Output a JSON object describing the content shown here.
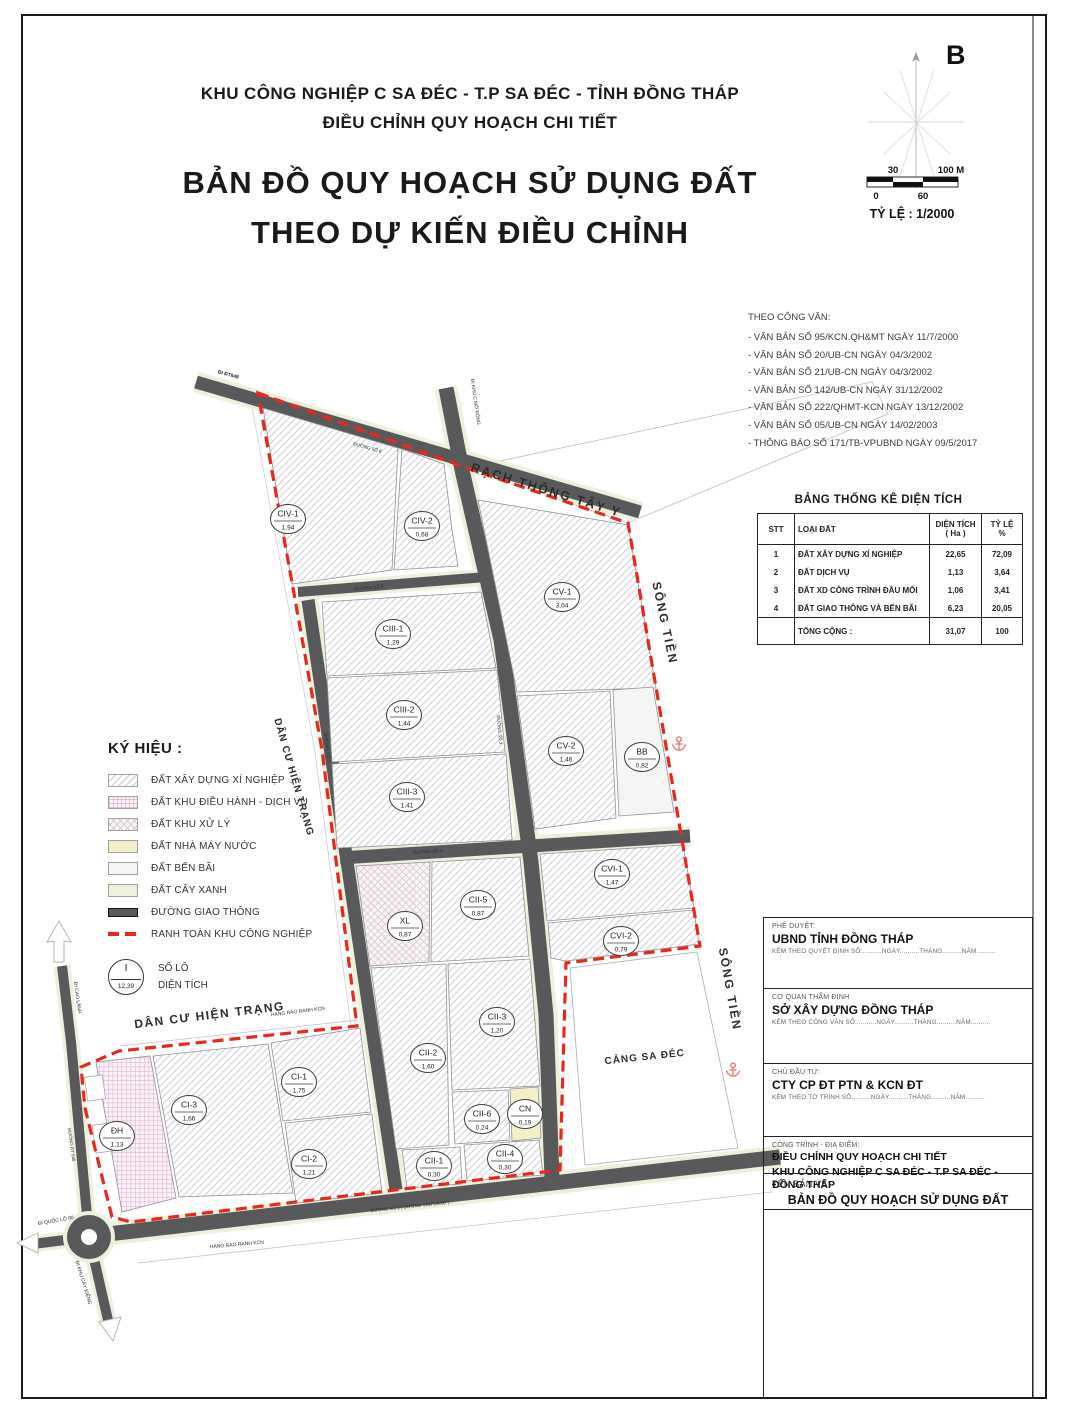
{
  "header": {
    "line1": "KHU CÔNG NGHIỆP C SA ĐÉC - T.P SA ĐÉC - TỈNH ĐỒNG THÁP",
    "line2": "ĐIỀU CHỈNH QUY HOẠCH CHI TIẾT",
    "title1": "BẢN ĐỒ QUY HOẠCH SỬ DỤNG ĐẤT",
    "title2": "THEO DỰ KIẾN ĐIỀU CHỈNH"
  },
  "compass": {
    "north_label": "B"
  },
  "scale_bar": {
    "top_left": "30",
    "top_right": "100 M",
    "bottom_left": "0",
    "bottom_mid": "60",
    "ratio": "TỶ LỆ : 1/2000"
  },
  "documents": {
    "heading": "THEO CÔNG VĂN:",
    "items": [
      "- VĂN BẢN SỐ 95/KCN.QH&MT NGÀY 11/7/2000",
      "- VĂN BẢN SỐ 20/UB-CN NGÀY 04/3/2002",
      "- VĂN BẢN SỐ 21/UB-CN NGÀY 04/3/2002",
      "- VĂN BẢN SỐ 142/UB-CN NGÀY 31/12/2002",
      "- VĂN BẢN SỐ 222/QHMT-KCN NGÀY 13/12/2002",
      "- VĂN BẢN SỐ 05/UB-CN NGÀY 14/02/2003",
      "- THÔNG BÁO SỐ 171/TB-VPUBND NGÀY 09/5/2017"
    ]
  },
  "area_table": {
    "title": "BẢNG THỐNG KÊ DIỆN TÍCH",
    "columns": [
      "STT",
      "LOẠI ĐẤT",
      "DIỆN TÍCH\n( Ha )",
      "TỶ LỆ\n%"
    ],
    "rows": [
      [
        "1",
        "ĐẤT XÂY DỰNG XÍ NGHIỆP",
        "22,65",
        "72,09"
      ],
      [
        "2",
        "ĐẤT DỊCH VỤ",
        "1,13",
        "3,64"
      ],
      [
        "3",
        "ĐẤT XD CÔNG TRÌNH ĐẦU MỐI",
        "1,06",
        "3,41"
      ],
      [
        "4",
        "ĐẤT GIAO THÔNG VÀ BẾN BÃI",
        "6,23",
        "20,05"
      ]
    ],
    "total_label": "TỔNG CỘNG :",
    "total_area": "31,07",
    "total_pct": "100"
  },
  "legend": {
    "title": "KÝ HIỆU  :",
    "items": [
      {
        "swatch": "hatch",
        "label": "ĐẤT XÂY DỰNG XÍ NGHIỆP"
      },
      {
        "swatch": "grid",
        "label": "ĐẤT KHU ĐIỀU HÀNH - DỊCH VỤ"
      },
      {
        "swatch": "cross",
        "label": "ĐẤT KHU XỬ LÝ"
      },
      {
        "swatch": "yellow",
        "label": "ĐẤT NHÀ MÁY NƯỚC"
      },
      {
        "swatch": "benbai",
        "label": "ĐẤT BẾN BÃI"
      },
      {
        "swatch": "green",
        "label": "ĐẤT CÂY XANH"
      },
      {
        "swatch": "road",
        "label": "ĐƯỜNG GIAO THÔNG"
      },
      {
        "swatch": "dashed",
        "label": "RANH TOÀN KHU CÔNG NGHIỆP"
      }
    ],
    "lot_symbol": {
      "top": "I",
      "bottom": "12,39",
      "label_top": "SỐ LÔ",
      "label_bottom": "DIỆN TÍCH"
    }
  },
  "map": {
    "colors": {
      "boundary_red": "#e8281e",
      "road_dark": "#58595a",
      "verge": "#edf0da",
      "anchor_red": "#e4736b"
    },
    "parcels": [
      {
        "code": "CIV-1",
        "area": "1,94",
        "x": 288,
        "y": 519
      },
      {
        "code": "CIV-2",
        "area": "0,68",
        "x": 422,
        "y": 526
      },
      {
        "code": "CV-1",
        "area": "3,04",
        "x": 562,
        "y": 597
      },
      {
        "code": "CIII-1",
        "area": "1,29",
        "x": 393,
        "y": 634
      },
      {
        "code": "CIII-2",
        "area": "1,44",
        "x": 404,
        "y": 715
      },
      {
        "code": "CIII-3",
        "area": "1,41",
        "x": 407,
        "y": 797
      },
      {
        "code": "CV-2",
        "area": "1,46",
        "x": 566,
        "y": 751
      },
      {
        "code": "BB",
        "area": "0,82",
        "x": 642,
        "y": 757
      },
      {
        "code": "CVI-1",
        "area": "1,47",
        "x": 612,
        "y": 874
      },
      {
        "code": "XL",
        "area": "0,87",
        "x": 405,
        "y": 926
      },
      {
        "code": "CII-5",
        "area": "0,87",
        "x": 478,
        "y": 905
      },
      {
        "code": "CVI-2",
        "area": "0,79",
        "x": 621,
        "y": 941
      },
      {
        "code": "CII-3",
        "area": "1,20",
        "x": 497,
        "y": 1022
      },
      {
        "code": "CII-2",
        "area": "1,60",
        "x": 428,
        "y": 1058
      },
      {
        "code": "CI-1",
        "area": "1,75",
        "x": 299,
        "y": 1082
      },
      {
        "code": "CI-3",
        "area": "1,66",
        "x": 189,
        "y": 1110
      },
      {
        "code": "ĐH",
        "area": "1,13",
        "x": 117,
        "y": 1136
      },
      {
        "code": "CII-6",
        "area": "0,24",
        "x": 482,
        "y": 1119
      },
      {
        "code": "CN",
        "area": "0,19",
        "x": 525,
        "y": 1114
      },
      {
        "code": "CI-2",
        "area": "1,21",
        "x": 309,
        "y": 1164
      },
      {
        "code": "CII-1",
        "area": "0,30",
        "x": 434,
        "y": 1166
      },
      {
        "code": "CII-4",
        "area": "0,30",
        "x": 505,
        "y": 1159
      }
    ],
    "labels": [
      {
        "t": "RẠCH THÔNG TÂY Y",
        "x": 545,
        "y": 494,
        "r": 17,
        "s": 12.5,
        "bold": true,
        "ls": 2
      },
      {
        "t": "SÔNG TIỀN",
        "x": 661,
        "y": 624,
        "r": 78,
        "s": 12,
        "bold": true,
        "ls": 2
      },
      {
        "t": "SÔNG TIỀN",
        "x": 726,
        "y": 990,
        "r": 80,
        "s": 12,
        "bold": true,
        "ls": 2
      },
      {
        "t": "DÂN CƯ HIỆN TRẠNG",
        "x": 291,
        "y": 778,
        "r": 74,
        "s": 10,
        "bold": true,
        "ls": 1
      },
      {
        "t": "DÂN CƯ HIỆN TRẠNG",
        "x": 210,
        "y": 1019,
        "r": -7,
        "s": 12,
        "bold": true,
        "ls": 1.5
      },
      {
        "t": "CẢNG SA ĐÉC",
        "x": 645,
        "y": 1060,
        "r": -6,
        "s": 10,
        "bold": true,
        "ls": 1
      },
      {
        "t": "HÀNG RÀO RANH KCN",
        "x": 298,
        "y": 1013,
        "r": -7,
        "s": 5
      },
      {
        "t": "HÀNG RÀO RANH KCN",
        "x": 237,
        "y": 1246,
        "r": -5,
        "s": 5
      },
      {
        "t": "ĐI ĐT848",
        "x": 228,
        "y": 376,
        "r": 15,
        "s": 5,
        "bold": true
      },
      {
        "t": "ĐI KHU C MỞ RỘNG",
        "x": 474,
        "y": 402,
        "r": 82,
        "s": 4.8
      },
      {
        "t": "ĐI CAO LÃNH",
        "x": 76,
        "y": 998,
        "r": 82,
        "s": 5
      },
      {
        "t": "ĐI QUỐC LỘ 80",
        "x": 56,
        "y": 1222,
        "r": -10,
        "s": 5
      },
      {
        "t": "ĐI KHU CÂY KIỂNG",
        "x": 82,
        "y": 1283,
        "r": 73,
        "s": 5
      },
      {
        "t": "ĐƯỜNG SỐ 8",
        "x": 367,
        "y": 449,
        "r": 16,
        "s": 4.5,
        "fill": "#ffffff"
      },
      {
        "t": "ĐƯỜNG SỐ 3",
        "x": 369,
        "y": 589,
        "r": -5,
        "s": 4.5,
        "fill": "#ffffff"
      },
      {
        "t": "ĐƯỜNG SỐ 2",
        "x": 498,
        "y": 730,
        "r": 85,
        "s": 4.5,
        "fill": "#ffffff"
      },
      {
        "t": "ĐƯỜNG SỐ 7",
        "x": 326,
        "y": 748,
        "r": 82,
        "s": 4.5,
        "fill": "#ffffff"
      },
      {
        "t": "ĐƯỜNG SỐ 4",
        "x": 428,
        "y": 853,
        "r": -3,
        "s": 4.5,
        "fill": "#ffffff"
      },
      {
        "t": "ĐƯỜNG SỐ 1 ( ĐƯỜNG VÀO CẢNG )",
        "x": 410,
        "y": 1208,
        "r": -6,
        "s": 4.5,
        "fill": "#ffffff"
      },
      {
        "t": "ĐƯỜNG ĐT 848",
        "x": 70,
        "y": 1145,
        "r": 82,
        "s": 4.5,
        "fill": "#4a4a4a"
      }
    ]
  },
  "title_block": {
    "approve_label": "PHÊ DUYỆT:",
    "approve_name": "UBND TỈNH ĐỒNG THÁP",
    "approve_note": "KÈM THEO QUYẾT ĐỊNH SỐ:..........NGÀY..........THÁNG..........NĂM..........",
    "review_label": "CƠ QUAN THẨM ĐỊNH",
    "review_name": "SỞ XÂY DỰNG ĐỒNG THÁP",
    "review_note": "KÈM THEO CÔNG VĂN SỐ:..........NGÀY..........THÁNG..........NĂM..........",
    "investor_label": "CHỦ ĐẦU TƯ:",
    "investor_name": "CTY CP ĐT PTN & KCN ĐT",
    "investor_note": "KÈM THEO TỜ TRÌNH SỐ..........NGÀY..........THÁNG..........NĂM..........",
    "project_label": "CÔNG TRÌNH - ĐỊA ĐIỂM:",
    "project_line1": "ĐIỀU CHỈNH QUY HOẠCH CHI TIẾT",
    "project_line2": "KHU CÔNG NGHIỆP C SA ĐÉC - T.P SA ĐÉC - ĐỒNG THÁP",
    "drawing_label": "TÊN BẢN VẼ:",
    "drawing_name": "BẢN ĐỒ QUY HOẠCH SỬ DỤNG ĐẤT"
  }
}
